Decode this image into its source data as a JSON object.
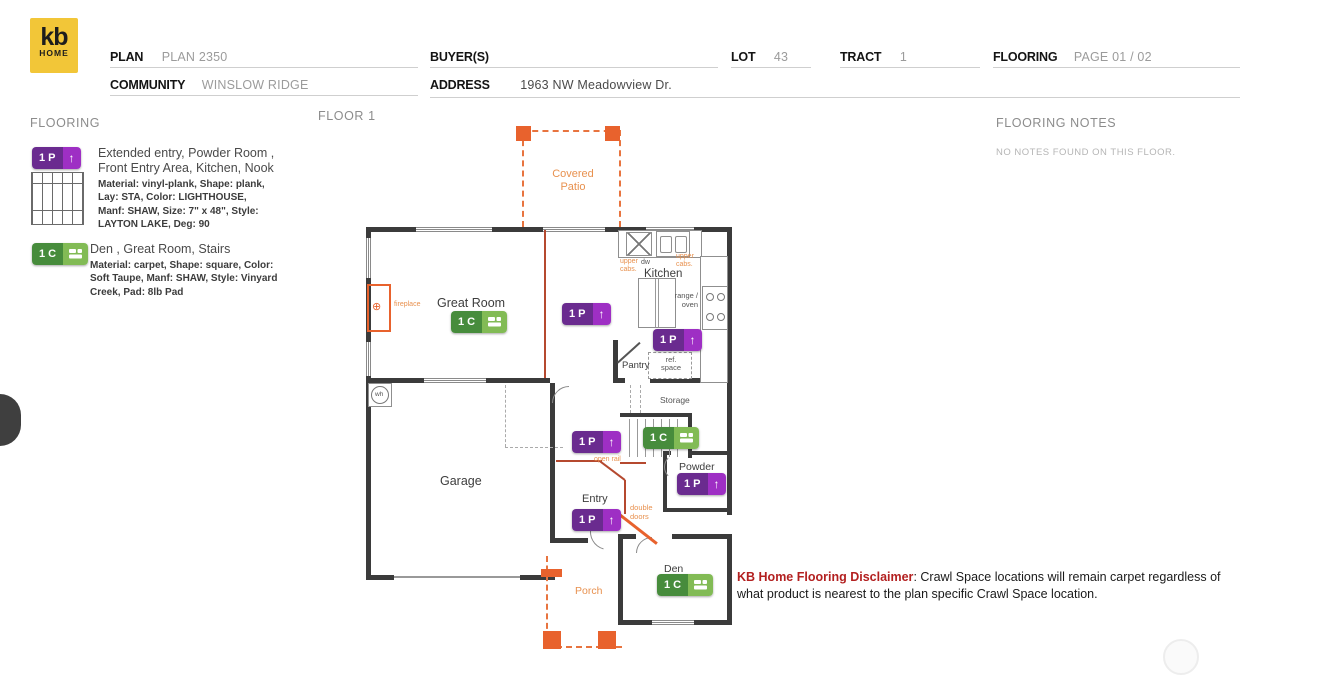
{
  "header": {
    "logo_top": "kb",
    "logo_bottom": "HOME",
    "plan_label": "PLAN",
    "plan_value": "PLAN 2350",
    "community_label": "COMMUNITY",
    "community_value": "WINSLOW RIDGE",
    "buyers_label": "BUYER(S)",
    "buyers_value": "",
    "address_label": "ADDRESS",
    "address_value": "1963 NW Meadowview Dr.",
    "lot_label": "LOT",
    "lot_value": "43",
    "tract_label": "TRACT",
    "tract_value": "1",
    "flooring_label": "FLOORING",
    "flooring_value": "PAGE 01 / 02"
  },
  "legend": {
    "title": "FLOORING",
    "items": [
      {
        "code": "1 P",
        "icon": "arrow-up",
        "rooms": "Extended entry, Powder Room , Front Entry Area, Kitchen, Nook",
        "specs": "Material: vinyl-plank, Shape: plank, Lay: STA, Color: LIGHTHOUSE, Manf: SHAW, Size: 7\" x 48\", Style: LAYTON LAKE, Deg: 90",
        "color_dark": "#6a2b8f",
        "color_light": "#9e2fc4"
      },
      {
        "code": "1 C",
        "icon": "carpet-tile",
        "rooms": "Den , Great Room, Stairs",
        "specs": "Material: carpet, Shape: square, Color: Soft Taupe, Manf: SHAW, Style: Vinyard Creek, Pad: 8lb Pad",
        "color_dark": "#478c3c",
        "color_light": "#82bb55"
      }
    ]
  },
  "plan": {
    "floor_title": "FLOOR 1",
    "icons": {
      "arrow_up": "↑",
      "fireplace_glyph": "⊕"
    },
    "labels": {
      "covered_patio": "Covered Patio",
      "great_room": "Great Room",
      "kitchen": "Kitchen",
      "pantry": "Pantry",
      "storage": "Storage",
      "garage": "Garage",
      "powder": "Powder",
      "entry": "Entry",
      "den": "Den",
      "porch": "Porch",
      "dw": "dw",
      "upper_cabs_left": "upper cabs.",
      "upper_cabs_right": "upper cabs.",
      "range_oven": "range / oven",
      "ref_space": "ref. space",
      "wh": "wh",
      "up": "Up",
      "open_rail": "open rail",
      "double_doors": "double doors",
      "fireplace": "fireplace"
    },
    "badges": [
      {
        "code": "1 C",
        "kind": "carpet"
      },
      {
        "code": "1 P",
        "kind": "plank"
      },
      {
        "code": "1 P",
        "kind": "plank"
      },
      {
        "code": "1 P",
        "kind": "plank"
      },
      {
        "code": "1 C",
        "kind": "carpet"
      },
      {
        "code": "1 P",
        "kind": "plank"
      },
      {
        "code": "1 P",
        "kind": "plank"
      },
      {
        "code": "1 C",
        "kind": "carpet"
      }
    ],
    "colors": {
      "wall": "#3b3b3b",
      "orange": "#e8622d",
      "purple": "#6a2b8f",
      "green": "#478c3c"
    }
  },
  "notes": {
    "title": "FLOORING NOTES",
    "body": "NO NOTES FOUND ON THIS FLOOR."
  },
  "disclaimer": {
    "title": "KB Home Flooring Disclaimer",
    "body": ": Crawl Space locations will remain carpet regardless of what product is nearest to the plan specific Crawl Space location."
  }
}
